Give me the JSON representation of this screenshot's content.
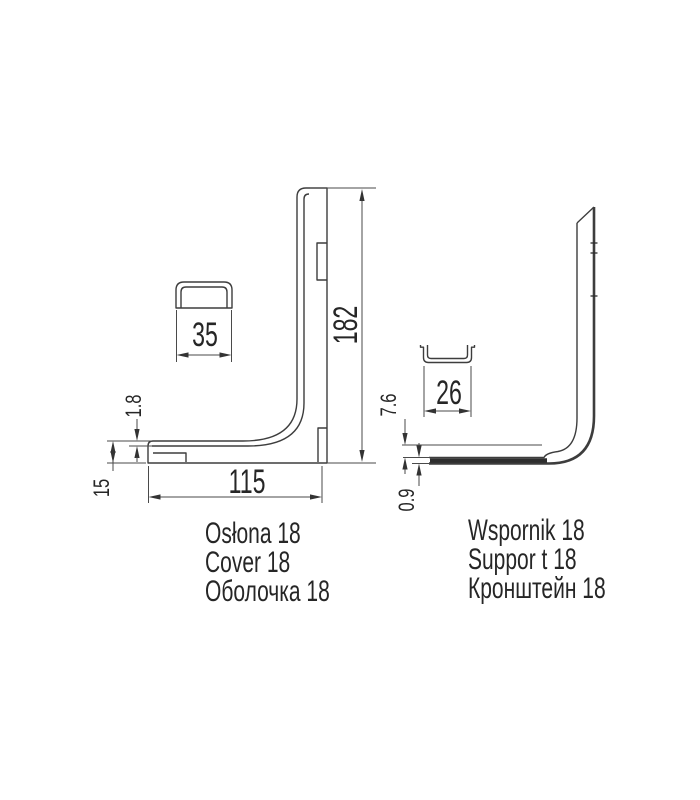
{
  "left_part": {
    "labels": [
      "Osłona 18",
      "Cover 18",
      "Оболочка 18"
    ],
    "dims": {
      "height": "182",
      "width": "115",
      "section_width": "35",
      "thickness": "1.8",
      "end_height": "15"
    }
  },
  "right_part": {
    "labels": [
      "Wspornik 18",
      "Suppor t 18",
      "Кронштейн 18"
    ],
    "dims": {
      "section_width": "26",
      "offset": "7.6",
      "thickness": "0.9"
    }
  },
  "colors": {
    "line": "#3d3d3d",
    "dim_line": "#4a4a4a",
    "text": "#262626",
    "background": "#ffffff"
  }
}
